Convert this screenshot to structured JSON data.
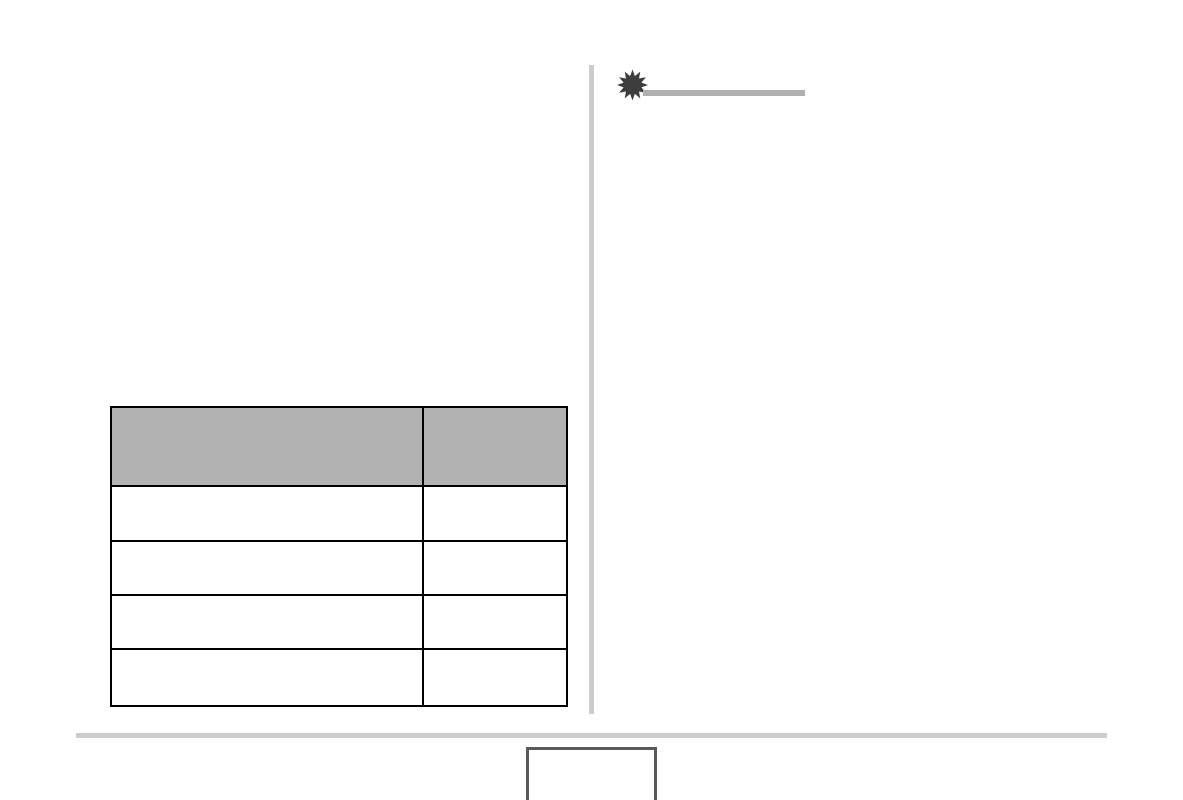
{
  "page": {
    "background": "#ffffff",
    "divider_color": "#cccccc"
  },
  "note_section": {
    "icon": "starburst-icon",
    "icon_color": "#3d3d3d",
    "rule_color": "#b0b0b0",
    "title": ""
  },
  "table": {
    "header_fill": "#b2b2b2",
    "border_color": "#000000",
    "columns": [
      "",
      ""
    ],
    "rows": [
      [
        "",
        ""
      ],
      [
        "",
        ""
      ],
      [
        "",
        ""
      ],
      [
        "",
        ""
      ]
    ]
  },
  "footer": {
    "rule_color": "#cccccc",
    "page_box": {
      "border_color": "#595959",
      "label": ""
    }
  }
}
